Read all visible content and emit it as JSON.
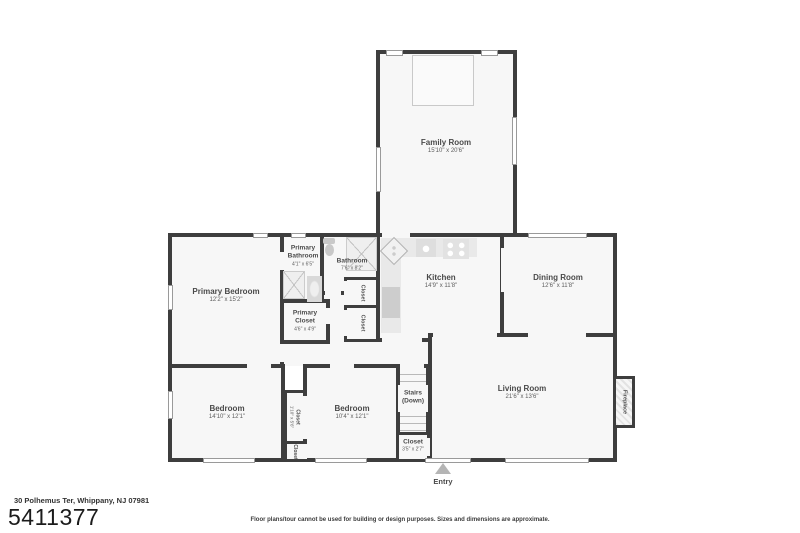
{
  "listing": {
    "address": "30 Polhemus Ter, Whippany, NJ 07981",
    "mls_number": "5411377",
    "disclaimer": "Floor plans/tour cannot be used for building or design purposes. Sizes and dimensions are approximate."
  },
  "plan": {
    "entry_label": "Entry",
    "rooms": {
      "family_room": {
        "name": "Family Room",
        "dims": "15'10\" x 20'6\""
      },
      "primary_bedroom": {
        "name": "Primary Bedroom",
        "dims": "12'2\" x 15'2\""
      },
      "primary_bathroom": {
        "name_line1": "Primary",
        "name_line2": "Bathroom",
        "dims": "4'1\" x 6'5\""
      },
      "bathroom": {
        "name": "Bathroom",
        "dims": "7'6\" x 8'2\""
      },
      "primary_closet": {
        "name_line1": "Primary",
        "name_line2": "Closet",
        "dims": "4'6\" x 4'9\""
      },
      "kitchen": {
        "name": "Kitchen",
        "dims": "14'9\" x 11'8\""
      },
      "dining_room": {
        "name": "Dining Room",
        "dims": "12'6\" x 11'8\""
      },
      "living_room": {
        "name": "Living Room",
        "dims": "21'6\" x 13'6\""
      },
      "bedroom_left": {
        "name": "Bedroom",
        "dims": "14'10\" x 12'1\""
      },
      "bedroom_right": {
        "name": "Bedroom",
        "dims": "10'4\" x 12'1\""
      },
      "stairs": {
        "name": "Stairs",
        "sub": "(Down)"
      },
      "entry_closet": {
        "name": "Closet",
        "dims": "3'5\" x 2'7\""
      },
      "hall_closet_upper": {
        "name": "Closet"
      },
      "hall_closet_lower": {
        "name": "Closet"
      },
      "bedroom_closet": {
        "name": "Closet",
        "dims": "1'10\" x 5'6\""
      },
      "bedroom_closet_lower": {
        "name": "Closet"
      },
      "fireplace": {
        "name": "Fireplace"
      }
    },
    "icons": {
      "entry_arrow": "triangle-up",
      "shower": "x-box",
      "toilet": "tank-and-bowl",
      "stove": "four-burners",
      "kitchen_sink": "diamond-double-basin"
    },
    "colors": {
      "wall": "#3e3e3e",
      "room_fill": "#f7f7f7",
      "fixture_gray": "#d9d9d9",
      "label_text": "#4a4a4a"
    }
  }
}
